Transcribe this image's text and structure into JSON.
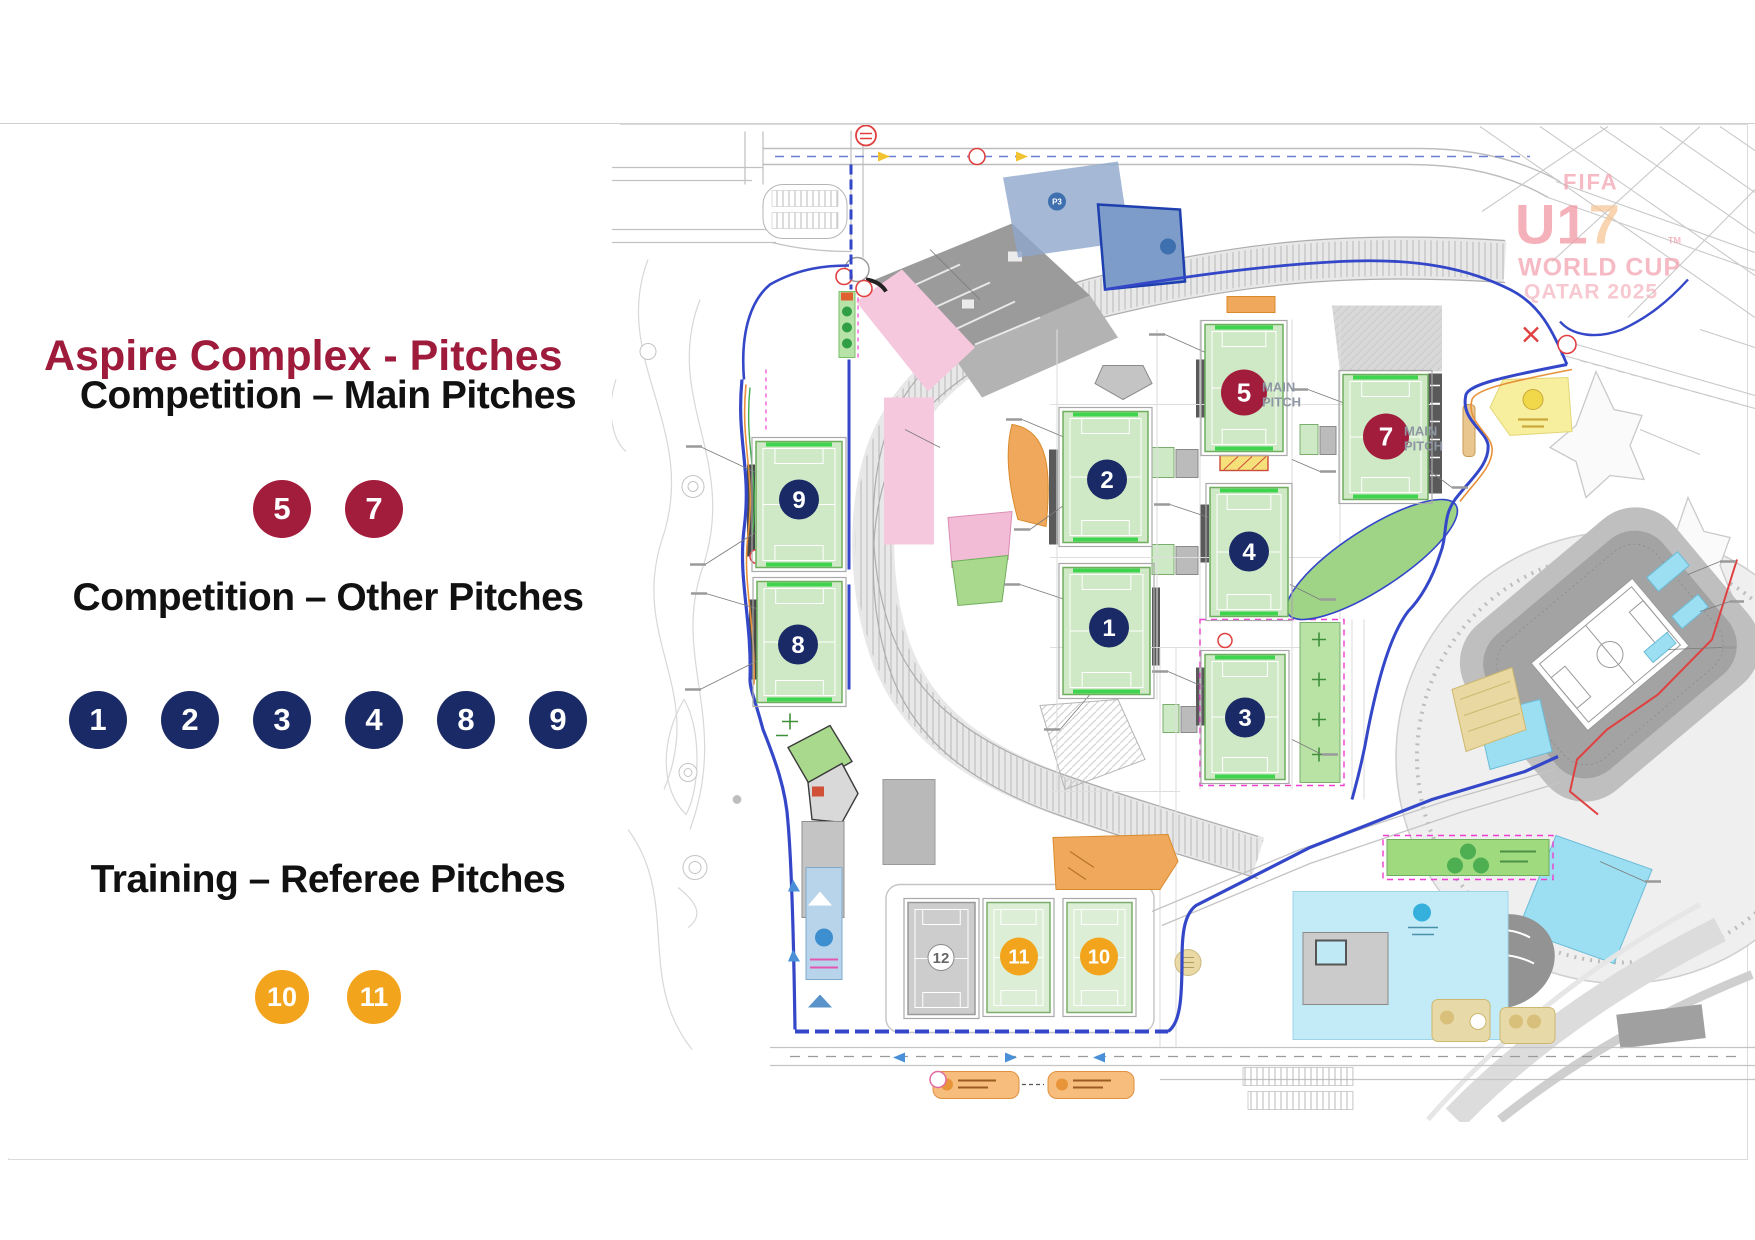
{
  "legend": {
    "title": "Aspire Complex - Pitches",
    "title_color": "#9E1B3C",
    "sections": [
      {
        "label": "Competition – Main Pitches",
        "badge_color": "#A21C3C",
        "badges": [
          "5",
          "7"
        ],
        "size": "big"
      },
      {
        "label": "Competition – Other Pitches",
        "badge_color": "#1A2A66",
        "badges": [
          "1",
          "2",
          "3",
          "4",
          "8",
          "9"
        ],
        "size": "row2"
      },
      {
        "label": "Training – Referee Pitches",
        "badge_color": "#F2A41C",
        "badges": [
          "10",
          "11"
        ],
        "size": "small"
      }
    ]
  },
  "map": {
    "watermark": {
      "fifa": "FIFA",
      "u1": "U1",
      "seven": "7",
      "tm": "TM",
      "world_cup": "WORLD CUP",
      "qatar": "QATAR 2025"
    },
    "labels": {
      "main_pitch_line1": "MAIN",
      "main_pitch_line2": "PITCH",
      "p3": "P3"
    },
    "pitch_styles": {
      "main": {
        "fill": "#CFE9C6",
        "stroke": "#6FAE5F",
        "marks": "#ffffff",
        "badge": "#A21C3C",
        "num": "#ffffff",
        "r": 23,
        "fs": 26,
        "bars": true
      },
      "other": {
        "fill": "#CFE9C6",
        "stroke": "#6FAE5F",
        "marks": "#ffffff",
        "badge": "#1A2A66",
        "num": "#ffffff",
        "r": 20,
        "fs": 24,
        "bars": true
      },
      "training": {
        "fill": "#DCEFD6",
        "stroke": "#7BAD6C",
        "marks": "#ffffff",
        "badge": "#F2A41C",
        "num": "#ffffff",
        "r": 19,
        "fs": 20,
        "bars": false
      },
      "neutral": {
        "fill": "#CDCDCD",
        "stroke": "#9A9A9A",
        "marks": "#ffffff",
        "badge": "#ffffff",
        "num": "#666666",
        "r": 13,
        "fs": 15,
        "bars": false,
        "badge_stroke": "#8a8a8a"
      }
    },
    "pitches": [
      {
        "n": "9",
        "style": "other",
        "x": 756,
        "y": 442,
        "w": 86,
        "h": 126,
        "bx": 799,
        "by": 500
      },
      {
        "n": "8",
        "style": "other",
        "x": 757,
        "y": 582,
        "w": 85,
        "h": 121,
        "bx": 798,
        "by": 645
      },
      {
        "n": "2",
        "style": "other",
        "x": 1063,
        "y": 412,
        "w": 85,
        "h": 131,
        "bx": 1107,
        "by": 480
      },
      {
        "n": "1",
        "style": "other",
        "x": 1063,
        "y": 568,
        "w": 87,
        "h": 127,
        "bx": 1109,
        "by": 628
      },
      {
        "n": "5",
        "style": "main",
        "x": 1205,
        "y": 325,
        "w": 78,
        "h": 127,
        "bx": 1244,
        "by": 393
      },
      {
        "n": "4",
        "style": "other",
        "x": 1210,
        "y": 488,
        "w": 78,
        "h": 129,
        "bx": 1249,
        "by": 552
      },
      {
        "n": "3",
        "style": "other",
        "x": 1205,
        "y": 655,
        "w": 80,
        "h": 125,
        "bx": 1245,
        "by": 718
      },
      {
        "n": "7",
        "style": "main",
        "x": 1343,
        "y": 375,
        "w": 85,
        "h": 125,
        "bx": 1386,
        "by": 437
      },
      {
        "n": "11",
        "style": "training",
        "x": 987,
        "y": 903,
        "w": 63,
        "h": 110,
        "bx": 1019,
        "by": 957
      },
      {
        "n": "10",
        "style": "training",
        "x": 1067,
        "y": 903,
        "w": 65,
        "h": 110,
        "bx": 1099,
        "by": 957
      },
      {
        "n": "12",
        "style": "neutral",
        "x": 908,
        "y": 903,
        "w": 67,
        "h": 112,
        "bx": 941,
        "by": 958
      }
    ],
    "colors": {
      "route_blue": "#3347C8",
      "magenta": "#EE3FD0",
      "cyan": "#ADE3F4",
      "sand": "#E9D8A2",
      "orange_zone": "#F0A95C",
      "watermark_pink": "#F2A0AE",
      "watermark_orange": "#F6C494"
    }
  }
}
